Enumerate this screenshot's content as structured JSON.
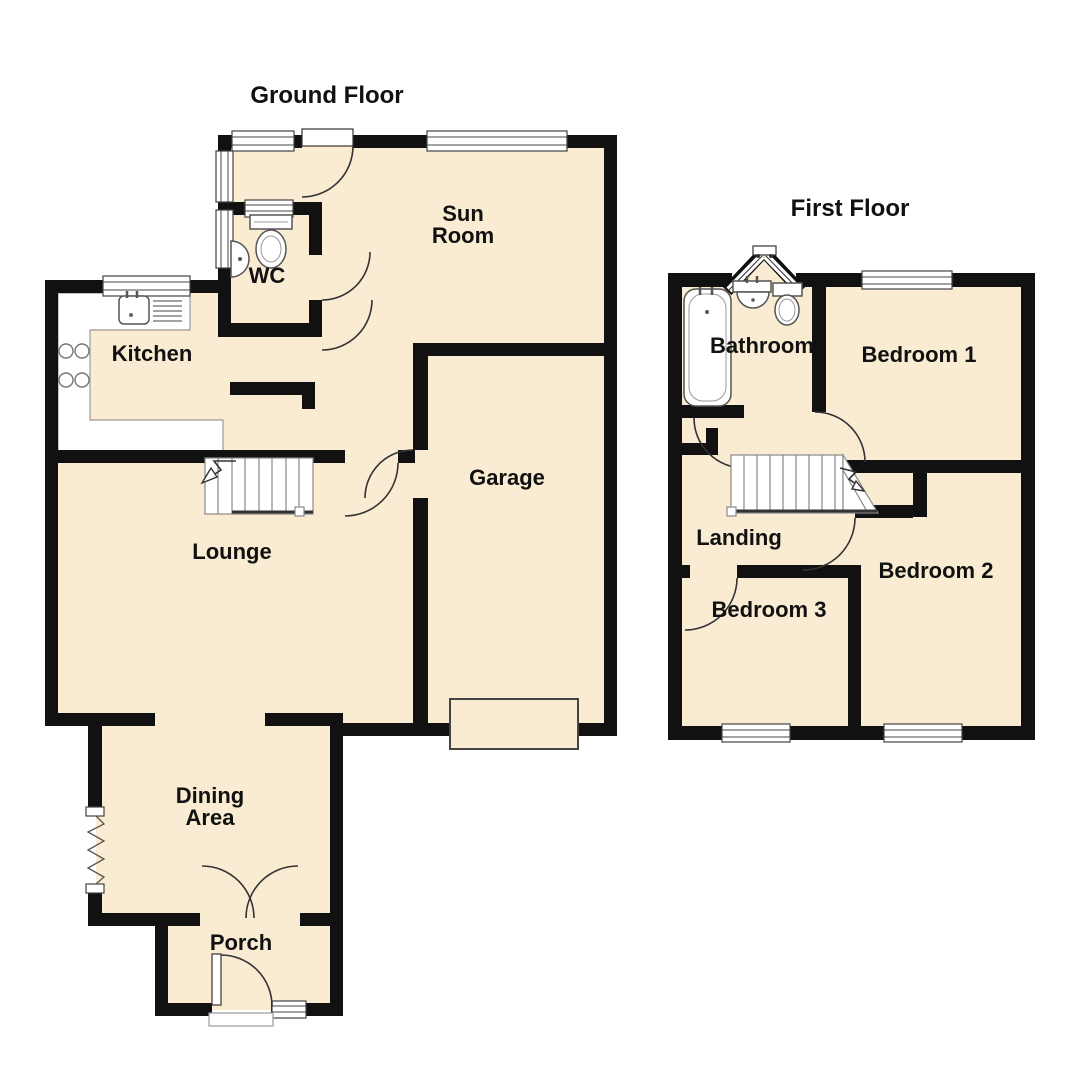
{
  "page": {
    "background": "#ffffff"
  },
  "plan": {
    "type": "floor-plan",
    "colors": {
      "room_fill": "#faecd2",
      "wall": "#111111",
      "window_frame": "#444444",
      "fixture_stroke": "#555555",
      "text": "#111111"
    },
    "ground_floor": {
      "title": "Ground Floor",
      "rooms": [
        {
          "name": "Sun Room"
        },
        {
          "name": "WC"
        },
        {
          "name": "Kitchen"
        },
        {
          "name": "Garage"
        },
        {
          "name": "Lounge"
        },
        {
          "name": "Dining Area"
        },
        {
          "name": "Porch"
        }
      ],
      "features": [
        "stairs-up-arrow",
        "kitchen-sink-drainer",
        "hob-4-rings",
        "wc-toilet",
        "wc-corner-basin",
        "garage-door",
        "double-doors-to-porch",
        "front-door-with-step",
        "zigzag-opening-dining"
      ]
    },
    "first_floor": {
      "title": "First Floor",
      "rooms": [
        {
          "name": "Bathroom"
        },
        {
          "name": "Bedroom 1"
        },
        {
          "name": "Landing"
        },
        {
          "name": "Bedroom 2"
        },
        {
          "name": "Bedroom 3"
        }
      ],
      "features": [
        "stairs-with-winders",
        "bath-tub",
        "basin",
        "toilet",
        "corner-bay-window"
      ]
    },
    "labels": {
      "ground_title": "Ground Floor",
      "first_title": "First Floor",
      "sun_room_1": "Sun",
      "sun_room_2": "Room",
      "wc": "WC",
      "kitchen": "Kitchen",
      "garage": "Garage",
      "lounge": "Lounge",
      "dining_1": "Dining",
      "dining_2": "Area",
      "porch": "Porch",
      "bathroom": "Bathroom",
      "bedroom1": "Bedroom 1",
      "landing": "Landing",
      "bedroom2": "Bedroom 2",
      "bedroom3": "Bedroom 3"
    }
  }
}
